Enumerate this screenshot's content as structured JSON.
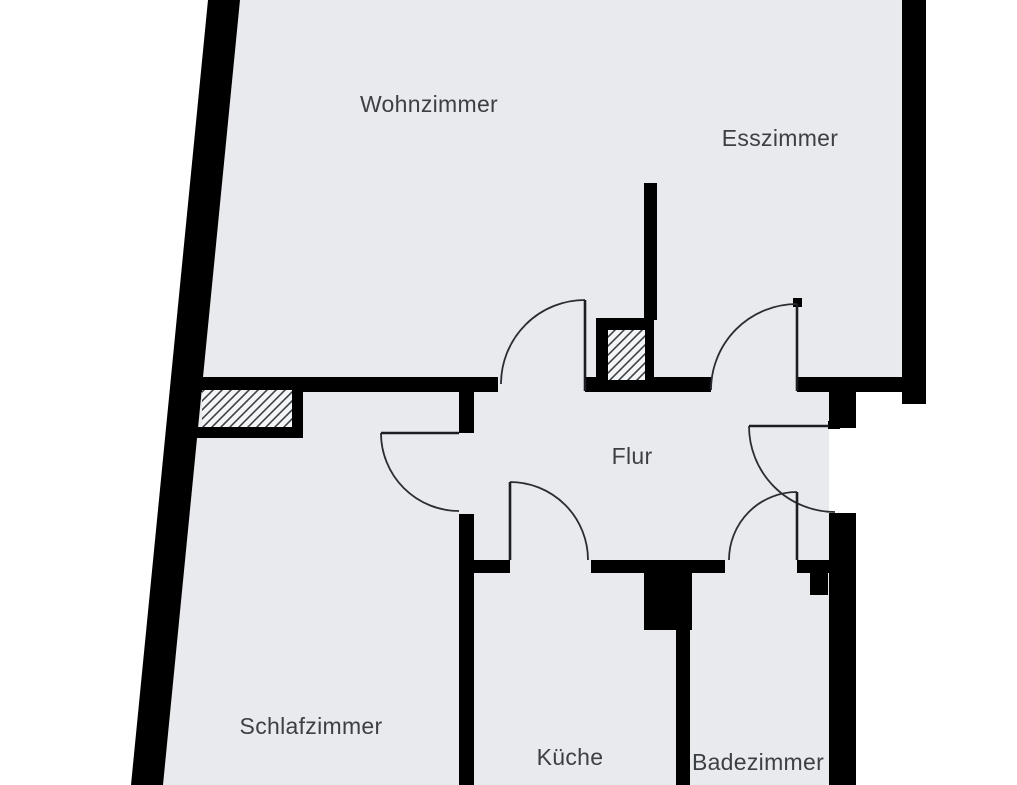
{
  "plan": {
    "kind": "apartment-floor-plan",
    "canvas": {
      "width": 1017,
      "height": 785
    }
  },
  "colors": {
    "outside": "#ffffff",
    "floor": "#e9eaee",
    "wall": "#000000",
    "door_line": "#2a2d32",
    "label_text": "#3c4043",
    "hatch_background": "#f4f5f7",
    "hatch_line": "#3f4245"
  },
  "rooms": [
    {
      "id": "wohnzimmer",
      "label": "Wohnzimmer",
      "label_x": 429,
      "label_y": 106
    },
    {
      "id": "esszimmer",
      "label": "Esszimmer",
      "label_x": 780,
      "label_y": 140
    },
    {
      "id": "flur",
      "label": "Flur",
      "label_x": 632,
      "label_y": 458
    },
    {
      "id": "schlafzimmer",
      "label": "Schlafzimmer",
      "label_x": 311,
      "label_y": 728
    },
    {
      "id": "kueche",
      "label": "Küche",
      "label_x": 570,
      "label_y": 759
    },
    {
      "id": "badezimmer",
      "label": "Badezimmer",
      "label_x": 758,
      "label_y": 764
    }
  ],
  "doors": [
    {
      "from": "flur",
      "to": "wohnzimmer"
    },
    {
      "from": "flur",
      "to": "esszimmer"
    },
    {
      "from": "flur",
      "to": "schlafzimmer"
    },
    {
      "from": "flur",
      "to": "kueche"
    },
    {
      "from": "flur",
      "to": "badezimmer"
    },
    {
      "from": "flur",
      "to": "outside"
    }
  ],
  "shafts": [
    {
      "id": "shaft-schlafzimmer-wall",
      "style": "hatched"
    },
    {
      "id": "shaft-flur-wall",
      "style": "hatched"
    },
    {
      "id": "shaft-kueche-wall",
      "style": "solid"
    }
  ]
}
